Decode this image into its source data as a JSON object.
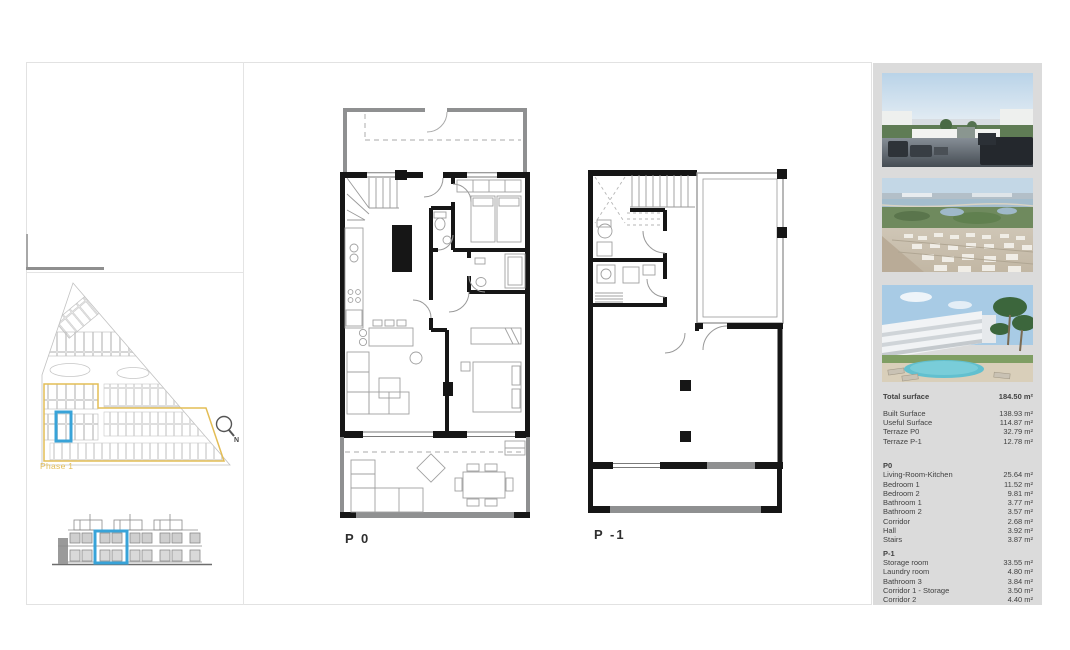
{
  "sheet": {
    "p0_label": "P 0",
    "p1_label": "P -1",
    "site": {
      "phase_label": "Phase 1",
      "compass_n": "N"
    }
  },
  "sidebar": {
    "photos": [
      {
        "name": "terrace-sea-view"
      },
      {
        "name": "aerial-coastline-view"
      },
      {
        "name": "residence-pool-view"
      }
    ],
    "total": {
      "label": "Total surface",
      "value": "184.50 m²"
    },
    "summary_rows": [
      {
        "label": "Built Surface",
        "value": "138.93 m²"
      },
      {
        "label": "Useful Surface",
        "value": "114.87 m²"
      },
      {
        "label": "Terraze P0",
        "value": "32.79 m²"
      },
      {
        "label": "Terraze P-1",
        "value": "12.78 m²"
      }
    ],
    "p0_heading": "P0",
    "p0_rows": [
      {
        "label": "Living-Room-Kitchen",
        "value": "25.64 m²"
      },
      {
        "label": "Bedroom 1",
        "value": "11.52 m²"
      },
      {
        "label": "Bedroom 2",
        "value": "9.81 m²"
      },
      {
        "label": "Bathroom 1",
        "value": "3.77 m²"
      },
      {
        "label": "Bathroom 2",
        "value": "3.57 m²"
      },
      {
        "label": "Corridor",
        "value": "2.68 m²"
      },
      {
        "label": "Hall",
        "value": "3.92 m²"
      },
      {
        "label": "Stairs",
        "value": "3.87 m²"
      }
    ],
    "p1_heading": "P-1",
    "p1_rows": [
      {
        "label": "Storage room",
        "value": "33.55 m²"
      },
      {
        "label": "Laundry room",
        "value": "4.80 m²"
      },
      {
        "label": "Bathroom 3",
        "value": "3.84 m²"
      },
      {
        "label": "Corridor 1 - Storage",
        "value": "3.50 m²"
      },
      {
        "label": "Corridor 2",
        "value": "4.40 m²"
      }
    ]
  },
  "colors": {
    "accent_blue": "#38a3d8",
    "phase_gold": "#e3bd55",
    "panel_gray": "#dbdbdb",
    "wall_black": "#161616",
    "wall_gray": "#8f9091"
  }
}
